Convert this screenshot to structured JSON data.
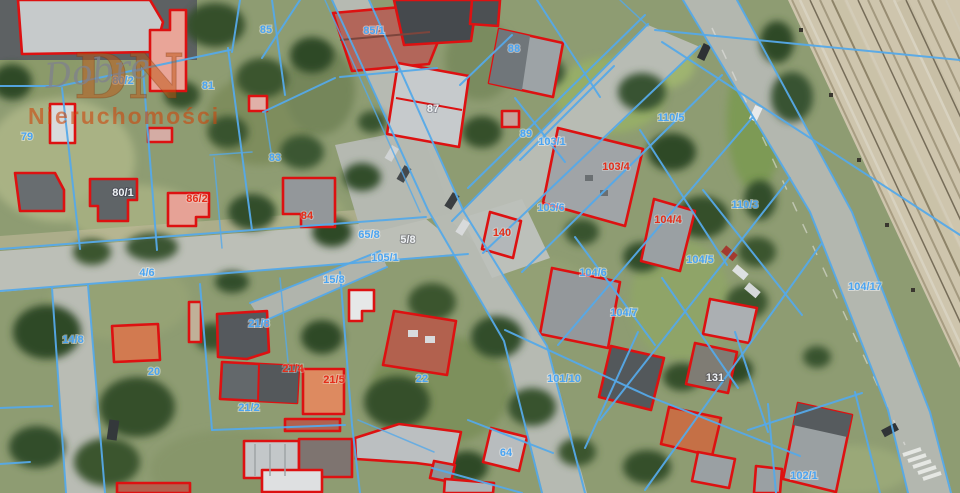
{
  "map": {
    "watermark": {
      "script": "Dobre",
      "initials": "DN",
      "name": "Nieruchomości"
    },
    "legend_colors": {
      "parcel_boundary_blue": "#55a9e8",
      "building_outline_red": "#dd1111",
      "label_blue": "#4aa4f2",
      "label_red": "#e42e1a",
      "label_white": "#eef1f4"
    },
    "parcel_labels": {
      "l79": {
        "text": "79"
      },
      "l80_2": {
        "text": "80/2"
      },
      "l81": {
        "text": "81"
      },
      "l85": {
        "text": "85"
      },
      "l85_1": {
        "text": "85/1"
      },
      "l83": {
        "text": "83"
      },
      "l86_2": {
        "text": "86/2"
      },
      "l80_1": {
        "text": "80/1"
      },
      "l84": {
        "text": "84"
      },
      "l87": {
        "text": "87"
      },
      "l88": {
        "text": "88"
      },
      "l89": {
        "text": "89"
      },
      "l103_1": {
        "text": "103/1"
      },
      "l110_5": {
        "text": "110/5"
      },
      "l110_3": {
        "text": "110/3"
      },
      "l103_4": {
        "text": "103/4"
      },
      "l103_6": {
        "text": "103/6"
      },
      "l104_4": {
        "text": "104/4"
      },
      "l104_5": {
        "text": "104/5"
      },
      "l104_6": {
        "text": "104/6"
      },
      "l104_7": {
        "text": "104/7"
      },
      "l104_17": {
        "text": "104/17"
      },
      "l101_10": {
        "text": "101/10"
      },
      "l131": {
        "text": "131"
      },
      "l102_1": {
        "text": "102/1"
      },
      "l64": {
        "text": "64"
      },
      "l22": {
        "text": "22"
      },
      "l20": {
        "text": "20"
      },
      "l21_8": {
        "text": "21/8"
      },
      "l21_4": {
        "text": "21/4"
      },
      "l21_5": {
        "text": "21/5"
      },
      "l21_2": {
        "text": "21/2"
      },
      "l140": {
        "text": "140"
      },
      "l4_6": {
        "text": "4/6"
      },
      "l14_8": {
        "text": "14/8"
      },
      "l15_8": {
        "text": "15/8"
      },
      "l65_8": {
        "text": "65/8"
      },
      "l5_8": {
        "text": "5/8"
      },
      "l105_1": {
        "text": "105/1"
      }
    }
  }
}
